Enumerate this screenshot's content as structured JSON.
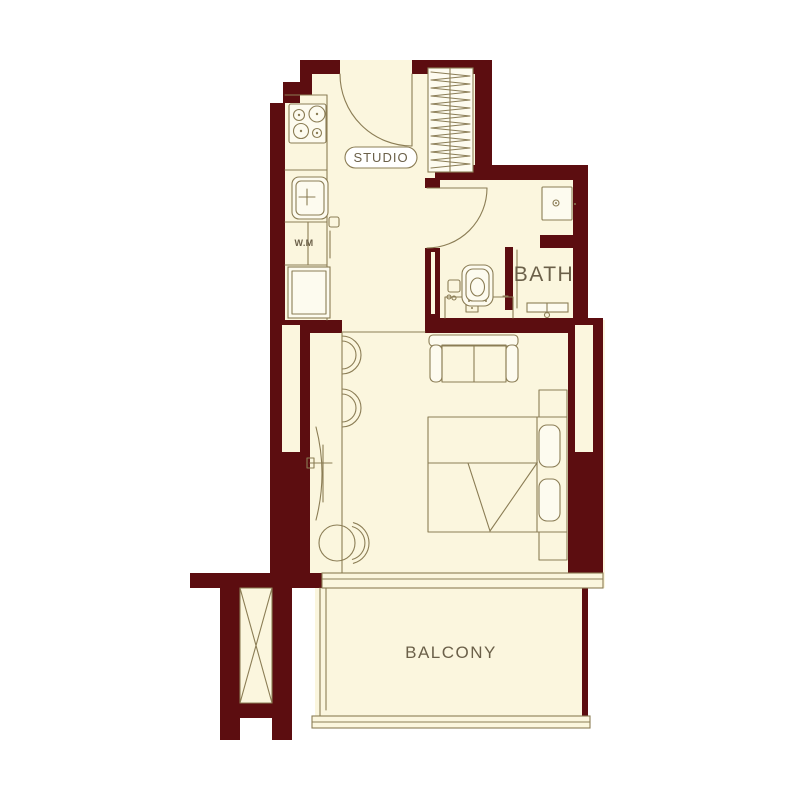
{
  "title": "Studio apartment floor plan",
  "labels": {
    "studio": "STUDIO",
    "bath": "BATH",
    "balcony": "BALCONY",
    "washing_machine": "W.M"
  },
  "colors": {
    "wall": "#5C0D10",
    "floor": "#FBF6DE",
    "fixture": "#FDFBEF",
    "line": "#8B7D55",
    "text": "#6B6049",
    "background": "#FFFFFF"
  }
}
